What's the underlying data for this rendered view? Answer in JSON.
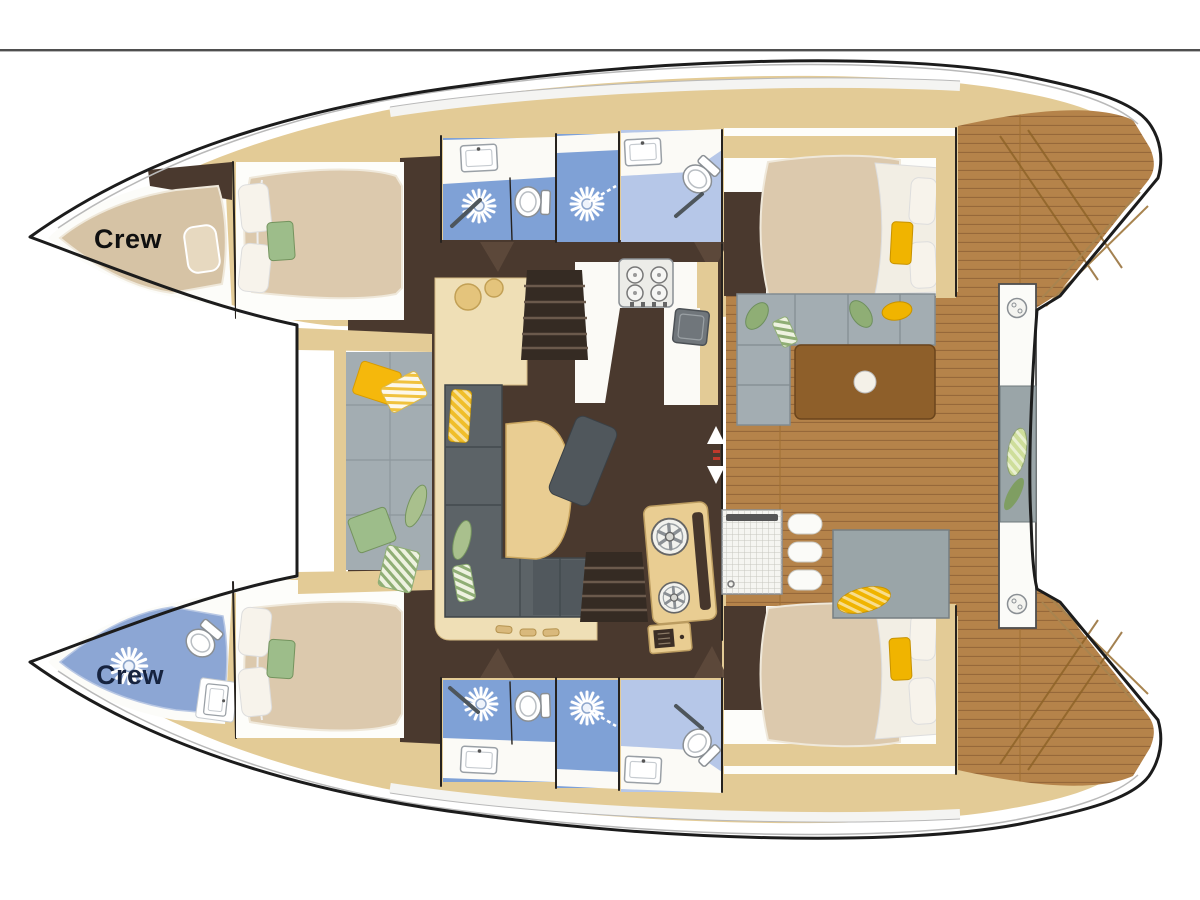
{
  "meta": {
    "diagram_type": "catamaran-interior-floorplan",
    "view": "top-down",
    "orientation": "bow-left-stern-right"
  },
  "labels": {
    "crew_port_bow": "Crew",
    "crew_starboard_bow": "Crew"
  },
  "colors": {
    "page_bg": "#ffffff",
    "divider_line": "#4f4f4f",
    "hull_fill": "#ffffff",
    "outline": "#1c1c1c",
    "tan_deck": "#e3cb96",
    "cream_furniture": "#efdfb6",
    "mattress_tan": "#dcc9ad",
    "dark_floor": "#4a392e",
    "bathroom_blue": "#7fa1d6",
    "bathroom_blue_light": "#b6c7e8",
    "crew_head_blue": "#8ca6d4",
    "sofa_gray": "#5c6367",
    "chaise_gray": "#50575c",
    "cushion_gray": "#a3adb2",
    "teak_deck": "#b5834a",
    "teak_line": "#96683a",
    "table_brown": "#8e5f2a",
    "accent_yellow": "#f0b400",
    "accent_green": "#9dbd8a",
    "crew_label_port": "#101010",
    "crew_label_starboard": "#16233f"
  },
  "icons": [
    "shower-head-icon",
    "toilet-icon",
    "sink-icon",
    "stove-icon",
    "winch-icon",
    "deck-hatch-icon",
    "door-arrow-icon"
  ],
  "areas": {
    "port_hull": [
      "crew-berth",
      "forward-cabin",
      "shower-room",
      "head-compartment",
      "aft-cabin"
    ],
    "starboard_hull": [
      "crew-head",
      "forward-cabin",
      "shower-room",
      "head-compartment",
      "aft-cabin"
    ],
    "bridge_deck": [
      "foredeck-lounge",
      "salon-settee",
      "salon-table",
      "galley",
      "companionway-stairs",
      "cockpit-lounge",
      "cockpit-table",
      "aft-transom-bench"
    ]
  }
}
